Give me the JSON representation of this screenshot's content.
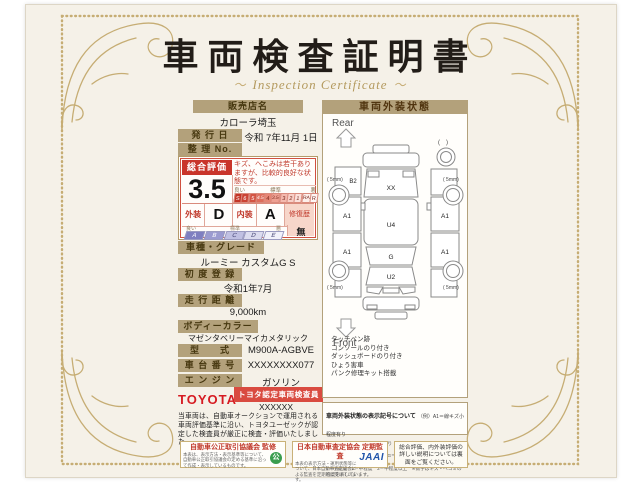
{
  "page": {
    "title": "車両検査証明書",
    "subtitle": "Inspection Certificate",
    "flourish_left": "～",
    "flourish_right": "～"
  },
  "dealer": {
    "label": "販売店名",
    "name": "カローラ埼玉"
  },
  "issue": {
    "label": "発 行 日",
    "value": "令和 7年11月 1日"
  },
  "ref_no": {
    "label": "整 理 No.",
    "value": ""
  },
  "evaluation": {
    "label": "総合評価",
    "score": "3.5",
    "comment": "キズ、へこみは若干ありますが、比較的良好な状態です。",
    "scale_labels": {
      "good": "良い",
      "mid": "標準",
      "bad": "悪"
    },
    "scale_cells": [
      "S",
      "6",
      "5",
      "4.5",
      "4",
      "3.5",
      "3",
      "2",
      "1",
      "RA",
      "R"
    ],
    "exterior_label": "外装",
    "exterior_grade": "D",
    "interior_label": "内装",
    "interior_grade": "A",
    "repair_label": "修復歴",
    "repair_value": "無",
    "grade_labels": {
      "good": "良い",
      "mid": "標準",
      "bad": "悪"
    },
    "grade_cells": [
      "A",
      "B",
      "C",
      "D",
      "E"
    ]
  },
  "specs": {
    "model_grade": {
      "label": "車種・グレード",
      "value": "ルーミー カスタムG S"
    },
    "first_reg": {
      "label": "初 度 登 録",
      "value": "令和1年7月"
    },
    "mileage": {
      "label": "走 行 距 離",
      "value": "9,000km"
    },
    "body_color": {
      "label": "ボディーカラー",
      "value": "マゼンタベリーマイカメタリック"
    },
    "model_code": {
      "label": "型　　式",
      "value": "M900A-AGBVE"
    },
    "chassis_no": {
      "label": "車 台 番 号",
      "value": "XXXXXXXX077"
    },
    "engine": {
      "label": "エ ン ジ ン",
      "value": "ガソリン"
    }
  },
  "certifier": {
    "logo": "TOYOTA",
    "badge": "トヨタ認定車両検査員",
    "inspector_no": "XXXXXX"
  },
  "disclaimer": "当車両は、自動車オークションで運用される車両評価基準に沿い、トヨタユーゼックが認定した検査員が厳正に検査・評価いたしました。",
  "exterior": {
    "title": "車両外装状態",
    "rear": "Rear",
    "front": "Front",
    "marks": {
      "hatch": "XX",
      "left_quarter": "B2",
      "left_rear_door": "A1",
      "left_front_door": "A1",
      "right_rear_door": "A1",
      "right_front_door": "A1",
      "roof": "U4",
      "windshield": "G",
      "hood": "U2"
    },
    "wheels": {
      "spare": "(　)",
      "rear_left": "( 5mm)",
      "rear_right": "( 5mm)",
      "front_left": "( 5mm)",
      "front_right": "( 5mm)"
    },
    "notes": [
      "タッチペン跡",
      "コンソールのり付き",
      "ダッシュボードのり付き",
      "ひょう害車",
      "パンク修理キット搭載"
    ]
  },
  "legend": {
    "title": "車両外装状態の表示記号について",
    "example": "（例）A1＝線キズ小程度有り",
    "lines": [
      "A＝線キズ有り　U＝ヘコミ有り　B＝キズとヘコミ有り　P＝塗装済有り　W＝補修跡有り",
      "S＝サビ有り　C＝腐食有り　G＝フロントガラスキズ有り　X＝要交換　(X)＝交換歴有り",
      "1＝小程度　2＝中程度　3＝中程度以上　※数字はキズ・ヘコミの程度を表しています。"
    ]
  },
  "footer": {
    "council": {
      "title": "自動車公正取引協議会 監修",
      "body": "本表は、表示方法・表示基準等について、自動車公正取引協議会の定める基準に沿って作成・表示しているものです。"
    },
    "jaai": {
      "title": "日本自動車査定協会 定期監査",
      "body": "本表の表示方法・運用状態等について、日本自動車査定協会による監査を定期的に受けています。",
      "logo": "JAAI"
    },
    "note": "総合評価、内外装評価の詳しい説明については裏面をご覧ください。"
  }
}
